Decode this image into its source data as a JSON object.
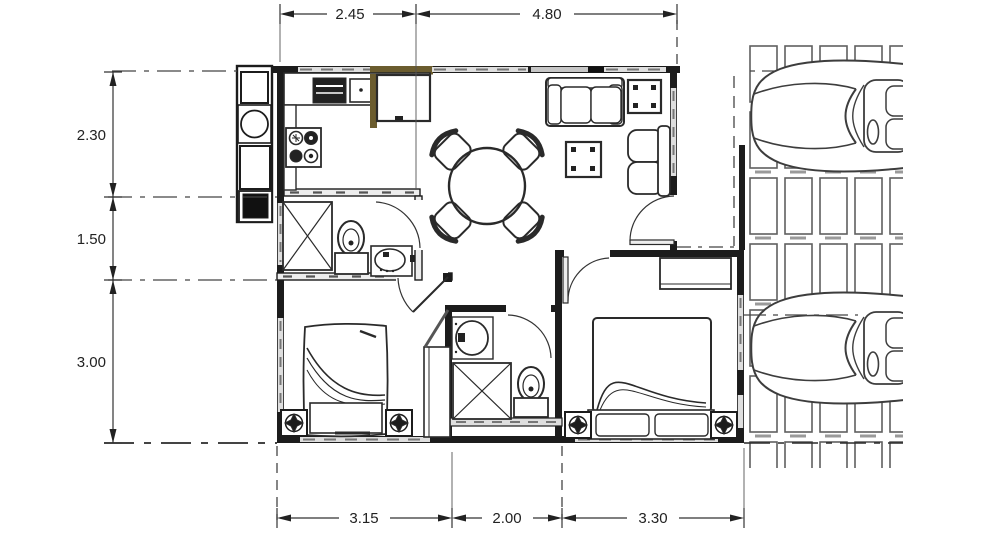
{
  "drawing": {
    "title": "house-floor-plan-with-carport",
    "dimensions": {
      "top": [
        "2.45",
        "4.80"
      ],
      "left": [
        "2.30",
        "1.50",
        "3.00"
      ],
      "bottom": [
        "3.15",
        "2.00",
        "3.30"
      ]
    },
    "colors": {
      "wall": "#1c1c1c",
      "line": "#333333",
      "window_fill": "#dedede",
      "window_dash": "#767676",
      "accent_brown": "#6b5c2e",
      "paver_line": "#5f5f5f",
      "car_line": "#3d3d3d"
    },
    "icons": [
      "dining-table-icon",
      "chair-icon",
      "sofa-icon",
      "armchair-icon",
      "side-table-icon",
      "coffee-table-icon",
      "stove-icon",
      "sink-icon",
      "fridge-icon",
      "oven-icon",
      "washer-icon",
      "shower-icon",
      "toilet-icon",
      "washbasin-icon",
      "bed-icon",
      "nightstand-lamp-icon",
      "wardrobe-icon",
      "car-icon",
      "paver-grid-icon",
      "door-swing-icon"
    ]
  }
}
